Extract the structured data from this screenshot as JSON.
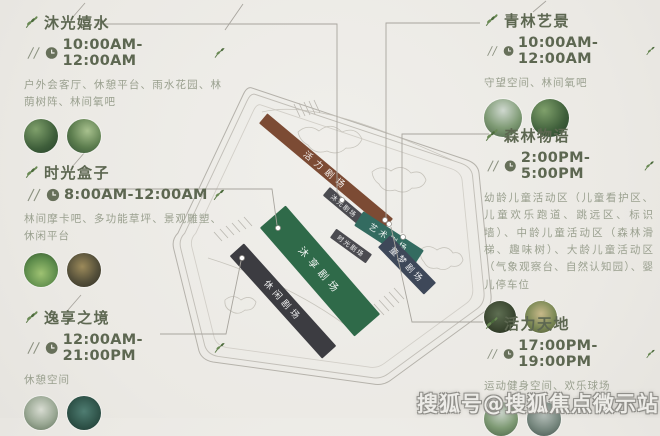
{
  "sections": {
    "left": [
      {
        "title": "沐光嬉水",
        "time": "10:00AM-12:00AM",
        "desc": "户外会客厅、休憩平台、雨水花园、林荫树阵、林间氧吧"
      },
      {
        "title": "时光盒子",
        "time": "8:00AM-12:00AM",
        "desc": "林间摩卡吧、多功能草坪、景观雕塑、休闲平台"
      },
      {
        "title": "逸享之境",
        "time": "12:00AM-21:00PM",
        "desc": "休憩空间"
      }
    ],
    "right": [
      {
        "title": "青林艺景",
        "time": "10:00AM-12:00AM",
        "desc": "守望空间、林间氧吧"
      },
      {
        "title": "森林物语",
        "time": "2:00PM-5:00PM",
        "desc": "幼龄儿童活动区（儿童看护区、儿童欢乐跑道、跳远区、标识墙）、中龄儿童活动区（森林滑梯、趣味树）、大龄儿童活动区（气象观察台、自然认知园）、婴儿停车位"
      },
      {
        "title": "活力天地",
        "time": "17:00PM-19:00PM",
        "desc": "运动健身空间、欢乐球场"
      }
    ]
  },
  "map": {
    "theaters": [
      {
        "label": "活力剧场",
        "color": "#7c4b34"
      },
      {
        "label": "沐光剧场",
        "color": "#4b4b50"
      },
      {
        "label": "艺术剧场",
        "color": "#336b60"
      },
      {
        "label": "时光剧场",
        "color": "#4b4b50"
      },
      {
        "label": "童梦剧场",
        "color": "#3e4859"
      },
      {
        "label": "沐享剧场",
        "color": "#2f6a49"
      },
      {
        "label": "休闲剧场",
        "color": "#3c3c41"
      }
    ]
  },
  "watermark": "搜狐号@搜狐焦点微示站",
  "colors": {
    "accent_olive": "#5d6751",
    "desc_gray": "#9aa08f",
    "line_gray": "#a8a59e"
  }
}
